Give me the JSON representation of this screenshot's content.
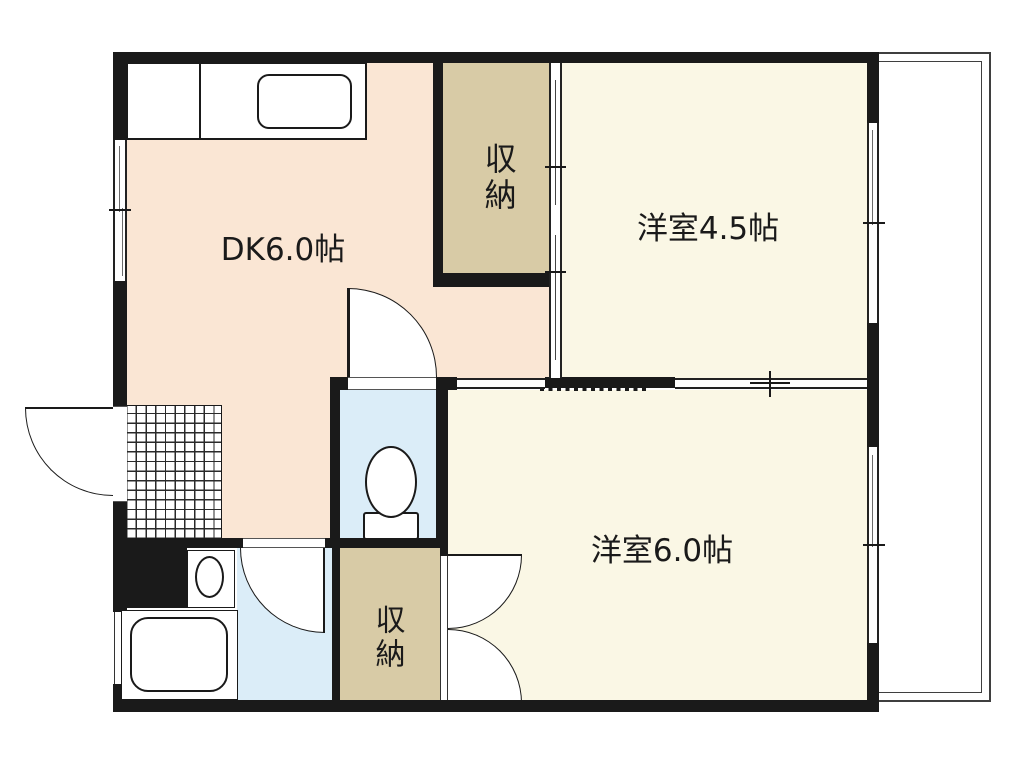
{
  "plan": {
    "rooms": {
      "dk": {
        "label": "DK6.0帖",
        "color": "#FAE6D4"
      },
      "western45": {
        "label": "洋室4.5帖",
        "color": "#FAF7E5"
      },
      "western60": {
        "label": "洋室6.0帖",
        "color": "#FAF7E5"
      },
      "closet_top": {
        "label": "収納",
        "color": "#D8CBA6"
      },
      "closet_bottom": {
        "label": "収納",
        "color": "#D8CBA6"
      },
      "toilet": {
        "color": "#DBEDF8"
      },
      "washroom": {
        "color": "#DBEDF8"
      }
    },
    "colors": {
      "wall": "#1a1a1a",
      "background": "#ffffff",
      "balcony_line": "#3f3f3f"
    },
    "fixtures": [
      "kitchen-sink",
      "toilet",
      "washbasin",
      "bathtub",
      "entrance-tile",
      "balcony"
    ]
  }
}
